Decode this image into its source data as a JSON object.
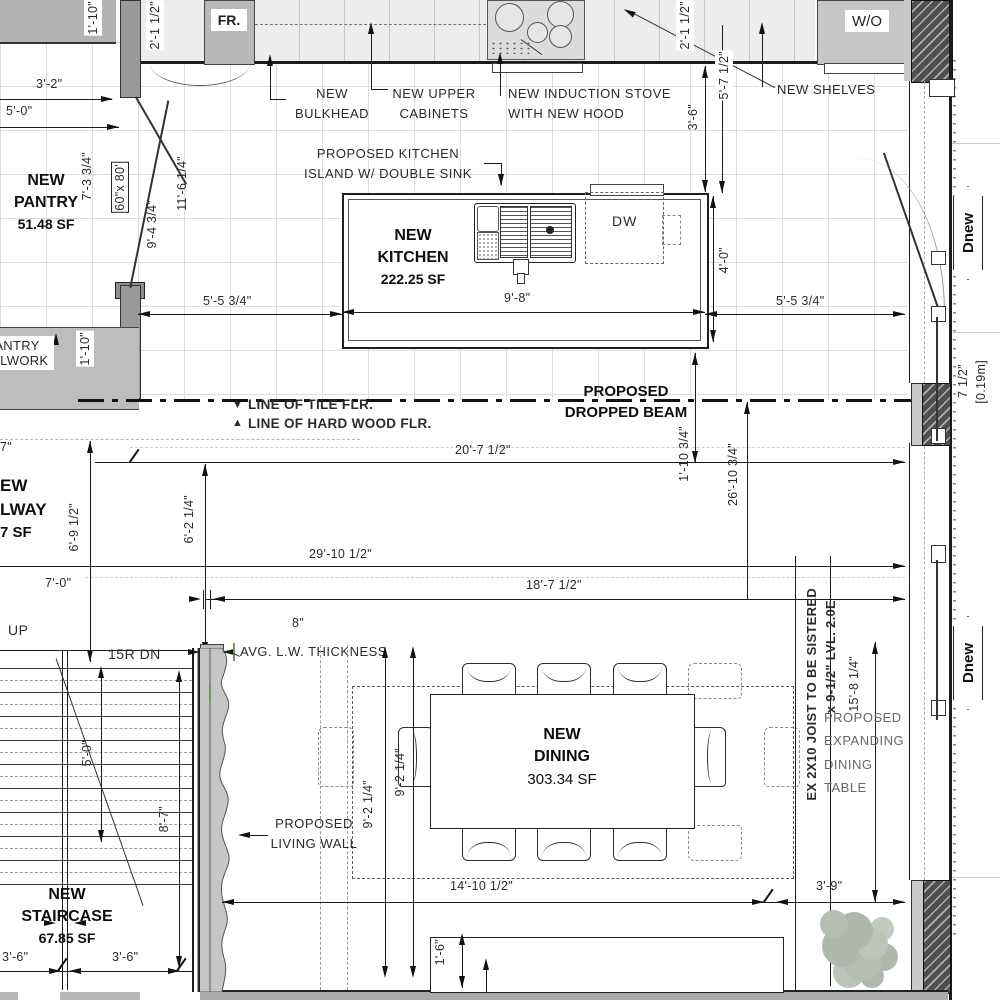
{
  "plan": {
    "appliances": {
      "fridge": "FR.",
      "wall_oven": "W/O",
      "dishwasher": "DW"
    },
    "notes": {
      "bulkhead_l1": "NEW",
      "bulkhead_l2": "BULKHEAD",
      "upper_l1": "NEW UPPER",
      "upper_l2": "CABINETS",
      "stove_l1": "NEW INDUCTION STOVE",
      "stove_l2": "WITH NEW HOOD",
      "shelves": "NEW SHELVES",
      "island_l1": "PROPOSED KITCHEN",
      "island_l2": "ISLAND W/ DOUBLE SINK",
      "beam_l1": "PROPOSED",
      "beam_l2": "DROPPED BEAM",
      "tile": "LINE OF TILE FLR.",
      "hardwood": "LINE OF HARD WOOD FLR.",
      "living_wall_l1": "PROPOSED",
      "living_wall_l2": "LIVING WALL",
      "lw_thickness": "AVG. L.W. THICKNESS",
      "up": "UP",
      "down": "15R DN",
      "joist_l1": "EX 2X10 JOIST TO BE SISTERED",
      "joist_l2": "x 9-1/2\" LVL. 2.0E",
      "expanding_l1": "PROPOSED",
      "expanding_l2": "EXPANDING",
      "expanding_l3": "DINING",
      "expanding_l4": "TABLE",
      "millwork_l1": "PANTRY",
      "millwork_l2": "MILLWORK"
    },
    "rooms": {
      "kitchen_l1": "NEW",
      "kitchen_l2": "KITCHEN",
      "kitchen_area": "222.25 SF",
      "pantry_l1": "NEW",
      "pantry_l2": "PANTRY",
      "pantry_area": "51.48 SF",
      "dining_l1": "NEW",
      "dining_l2": "DINING",
      "dining_area": "303.34 SF",
      "stair_l1": "NEW",
      "stair_l2": "STAIRCASE",
      "stair_area": "67.85 SF",
      "hall_f1": "EW",
      "hall_f2": "LWAY",
      "hall_f3": "7 SF"
    },
    "dims": {
      "d110a": "1'-10\"",
      "d2112a": "2'-1 1/2\"",
      "d32": "3'-2\"",
      "d50": "5'-0\"",
      "d7334": "7'-3 3/4\"",
      "d9434": "9'-4 3/4\"",
      "d11614": "11'-6 1/4\"",
      "d110b": "1'-10\"",
      "d5534a": "5'-5 3/4\"",
      "d98": "9'-8\"",
      "d5534b": "5'-5 3/4\"",
      "d40": "4'-0\"",
      "d36r": "3'-6\"",
      "d5712": "5'-7 1/2\"",
      "d2112b": "2'-1 1/2\"",
      "d20712": "20'-7 1/2\"",
      "d11034": "1'-10 3/4\"",
      "d261034": "26'-10 3/4\"",
      "d291012": "29'-10 1/2\"",
      "d18712": "18'-7 1/2\"",
      "d6912": "6'-9 1/2\"",
      "d6214": "6'-2 1/4\"",
      "d70": "7'-0\"",
      "d7": "7\"",
      "d8": "8\"",
      "d50s": "5'-0\"",
      "d87": "8'-7\"",
      "d36a": "3'-6\"",
      "d36b": "3'-6\"",
      "d9214a": "9'-2 1/4\"",
      "d9214b": "9'-2 1/4\"",
      "d141012": "14'-10 1/2\"",
      "d16": "1'-6\"",
      "d39": "3'-9\"",
      "d15814": "15'-8 1/4\"",
      "d712": "7 1/2\"",
      "dm019": "[0.19m]"
    },
    "tags": {
      "dnew": "Dnew",
      "door_size": "60\"x 80'"
    },
    "icons": {
      "tri_down": "▼",
      "tri_up": "▲"
    },
    "colors": {
      "wall_gray": "#b5b5b5",
      "dark_wall": "#4f4f4f",
      "plant": "#b6beb3",
      "green_mark": "#6f9a5e"
    }
  }
}
